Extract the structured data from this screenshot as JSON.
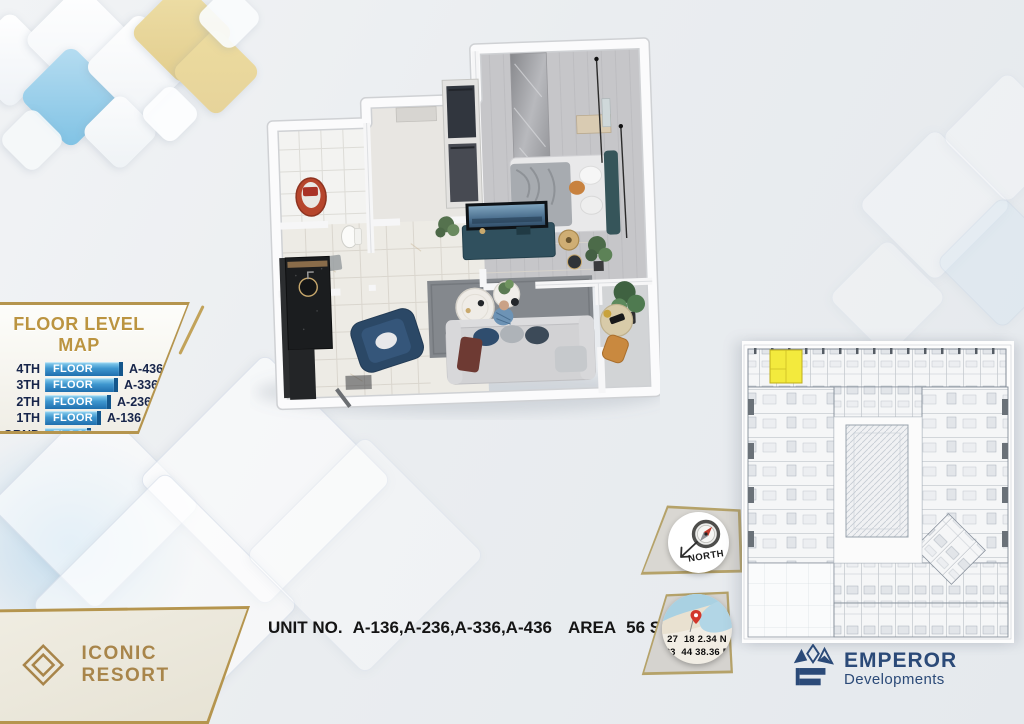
{
  "floor_map": {
    "title": "FLOOR LEVEL MAP",
    "rows": [
      {
        "level": "4TH",
        "bar": "FLOOR",
        "unit": "A-436"
      },
      {
        "level": "3TH",
        "bar": "FLOOR",
        "unit": "A-336"
      },
      {
        "level": "2TH",
        "bar": "FLOOR",
        "unit": "A-236"
      },
      {
        "level": "1TH",
        "bar": "FLOOR",
        "unit": "A-136"
      },
      {
        "level": "GRND",
        "bar": "FLOOR",
        "unit": ""
      }
    ]
  },
  "unit_info": {
    "label": "UNIT NO.",
    "units": "A-136,A-236,A-336,A-436",
    "area_label": "AREA",
    "area_value": "56 SQM"
  },
  "compass": {
    "label": "NORTH"
  },
  "location": {
    "line1": "27  18 2.34 N",
    "line2": "33  44 38.36 E"
  },
  "brand": {
    "name": "ICONIC RESORT"
  },
  "developer": {
    "name": "EMPEROR",
    "subtitle": "Developments"
  },
  "colors": {
    "gold": "#b5954e",
    "navy_text": "#17254a",
    "bar_blue": "#2e86c4",
    "highlight_yellow": "#f3ea3d",
    "brand_gold": "#a8854a",
    "developer_navy": "#2b4a78",
    "tub_red": "#b6452c"
  }
}
